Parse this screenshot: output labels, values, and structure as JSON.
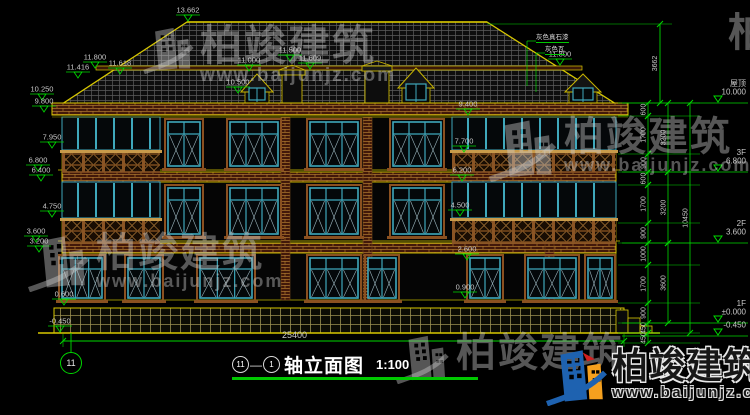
{
  "drawing": {
    "title": {
      "axis_start_bubble": "11",
      "separator": "—",
      "axis_end_bubble": "1",
      "name": "轴立面图",
      "scale": "1:100"
    },
    "bottom_axis_bubble": "11",
    "overall_dimension": "25400",
    "material_callouts": [
      "灰色真石漆",
      "灰色瓦"
    ],
    "spot_levels": [
      [
        "13.662",
        188,
        22
      ],
      [
        "11.800",
        95,
        69
      ],
      [
        "11.416",
        78,
        79
      ],
      [
        "11.618",
        120,
        75
      ],
      [
        "10.250",
        42,
        101
      ],
      [
        "9.800",
        44,
        113
      ],
      [
        "11.000",
        249,
        72
      ],
      [
        "10.500",
        238,
        94
      ],
      [
        "11.500",
        290,
        62
      ],
      [
        "11.609",
        310,
        70
      ],
      [
        "11.800",
        560,
        66
      ],
      [
        "9.400",
        468,
        116
      ],
      [
        "7.700",
        464,
        153
      ],
      [
        "6.200",
        462,
        182
      ],
      [
        "4.500",
        460,
        217
      ],
      [
        "2.600",
        467,
        261
      ],
      [
        "0.900",
        465,
        299
      ],
      [
        "7.950",
        52,
        149
      ],
      [
        "6.800",
        38,
        172
      ],
      [
        "6.400",
        41,
        182
      ],
      [
        "4.750",
        52,
        218
      ],
      [
        "3.600",
        36,
        243
      ],
      [
        "3.200",
        39,
        253
      ],
      [
        "0.600",
        64,
        306
      ],
      [
        "-0.450",
        60,
        333
      ]
    ],
    "levels_right": [
      {
        "name": "屋顶",
        "value": "10.000",
        "y": 103
      },
      {
        "name": "3F",
        "value": "6.800",
        "y": 172
      },
      {
        "name": "2F",
        "value": "3.600",
        "y": 243
      },
      {
        "name": "1F",
        "value": "±0.000",
        "y": 323
      },
      {
        "name": "",
        "value": "-0.450",
        "y": 336
      }
    ],
    "roof_height_dim": {
      "value": "3662",
      "x": 660,
      "y1": 24,
      "y2": 103
    },
    "right_dim_columns": [
      {
        "x": 648,
        "segments": [
          [
            "600",
            103,
            116
          ],
          [
            "1700",
            116,
            154
          ],
          [
            "900",
            154,
            172
          ],
          [
            "600",
            172,
            185
          ],
          [
            "1700",
            185,
            223
          ],
          [
            "900",
            223,
            243
          ],
          [
            "1000",
            243,
            265
          ],
          [
            "1700",
            265,
            303
          ],
          [
            "900",
            303,
            323
          ],
          [
            "450",
            323,
            333
          ],
          [
            "450",
            333,
            343
          ]
        ]
      },
      {
        "x": 668,
        "segments": [
          [
            "3200",
            103,
            172
          ],
          [
            "3200",
            172,
            243
          ],
          [
            "3600",
            243,
            323
          ]
        ]
      },
      {
        "x": 690,
        "segments": [
          [
            "10450",
            103,
            333
          ]
        ]
      }
    ]
  },
  "watermark": {
    "brand": "柏竣建筑",
    "url": "www.baijunjz.com"
  },
  "colors": {
    "cad_green": "#00d800",
    "cad_yellow": "#d8c800",
    "window_teal": "#3fa8bc",
    "wood_brown": "#9a6a30",
    "brick_red": "#42180a",
    "dim_text": "#c8c8c8",
    "logo_blue": "#1e62b0",
    "logo_orange": "#f5a01e"
  }
}
